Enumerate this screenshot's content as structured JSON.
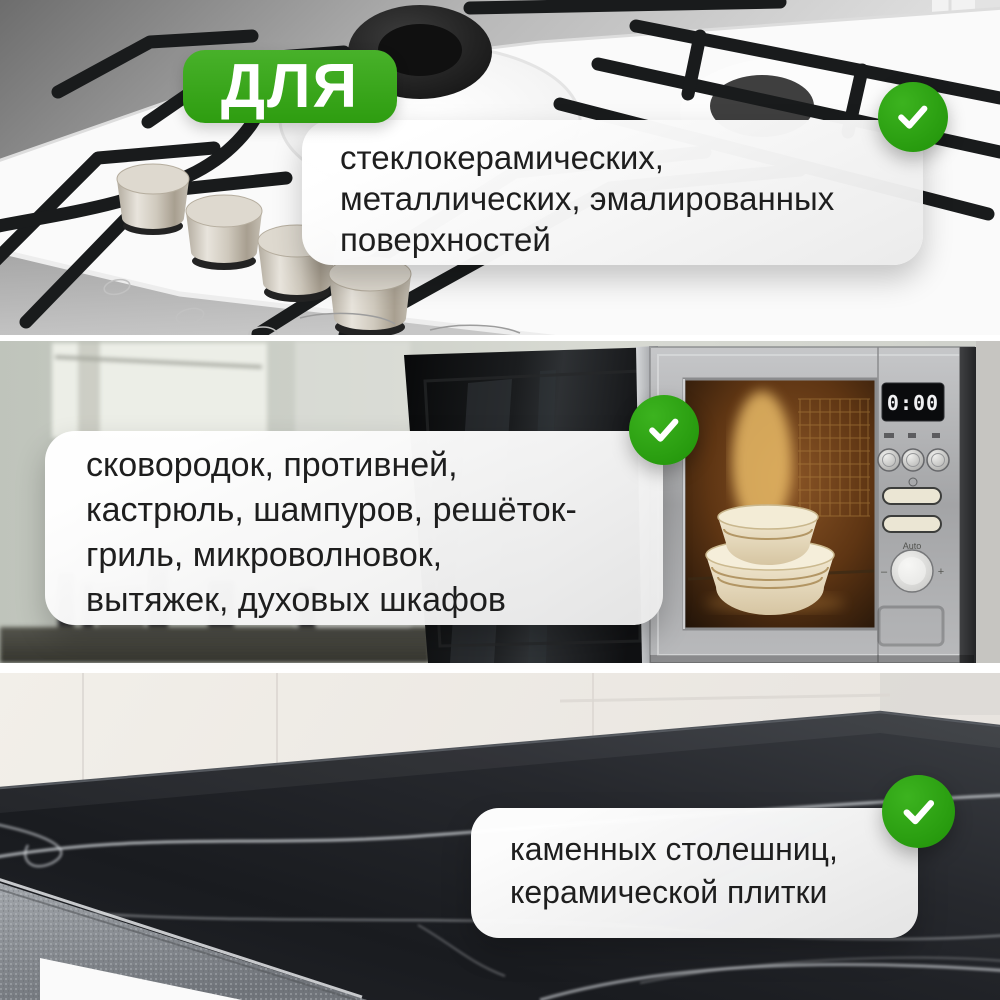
{
  "colors": {
    "accent_green": "#2fa113",
    "card_background": "#f3f3f3",
    "text": "#1e1e1e",
    "divider_white": "#ffffff"
  },
  "badge": {
    "label": "ДЛЯ"
  },
  "sections": [
    {
      "id": "stove",
      "photo": "white gas stove with black grates and metal knobs",
      "card": {
        "lines": [
          "стеклокерамических,",
          "металлических, эмалированных",
          "поверхностей"
        ]
      }
    },
    {
      "id": "microwave",
      "photo": "built-in microwave with open door and bowls inside",
      "display_time": "0:00",
      "dial_label": "Auto",
      "dial_minus": "–",
      "dial_plus": "+",
      "card": {
        "lines": [
          "сковородок, противней,",
          "кастрюль, шампуров, решёток-",
          "гриль, микроволновок,",
          "вытяжек, духовых шкафов"
        ]
      }
    },
    {
      "id": "countertop",
      "photo": "black stone countertop with white marble veins",
      "card": {
        "lines": [
          "каменных столешниц,",
          "керамической плитки"
        ]
      }
    }
  ]
}
